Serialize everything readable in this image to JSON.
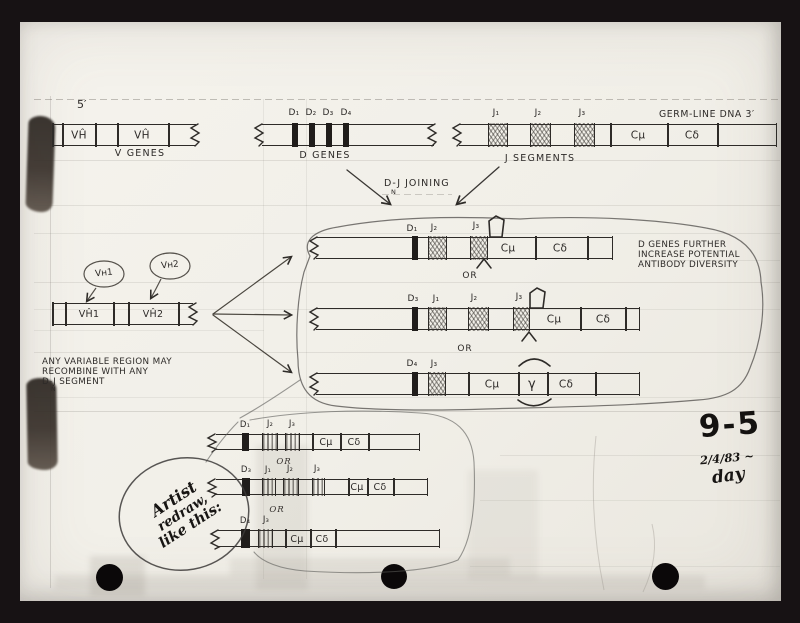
{
  "document": {
    "figure_number": "9-5",
    "date": "2/4/83 ~",
    "signoff": "day"
  },
  "germline_row": {
    "five_prime": "5′",
    "three_prime": "GERM-LINE DNA 3′",
    "v_genes": {
      "caption": "V GENES",
      "segment1": "VĤ",
      "segment2": "VĤ"
    },
    "d_genes": {
      "caption": "D GENES",
      "d1": "D₁",
      "d2": "D₂",
      "d3": "D₃",
      "d4": "D₄"
    },
    "j_segments": {
      "caption": "J SEGMENTS",
      "j1": "J₁",
      "j2": "J₂",
      "j3": "J₃",
      "c_mu": "Cμ",
      "c_delta": "Cδ"
    }
  },
  "joining": {
    "label": "D-J JOINING",
    "n": "N"
  },
  "rearranged": {
    "or": "OR",
    "note": {
      "line1": "D GENES FURTHER",
      "line2": "INCREASE POTENTIAL",
      "line3": "ANTIBODY DIVERSITY"
    },
    "row1": {
      "d": "D₁",
      "j1": "J₂",
      "j2": "J₃",
      "c_mu": "Cμ",
      "c_delta": "Cδ"
    },
    "row2": {
      "d": "D₃",
      "j1": "J₁",
      "j2": "J₂",
      "j3": "J₃",
      "c_mu": "Cμ",
      "c_delta": "Cδ"
    },
    "row3": {
      "d": "D₄",
      "j1": "J₃",
      "c_mu": "Cμ",
      "gamma": "γ",
      "c_delta": "Cδ"
    }
  },
  "variable_region": {
    "bubble1": "Vʜ1",
    "bubble2": "Vʜ2",
    "segment1": "VĤ1",
    "segment2": "VĤ2",
    "note": {
      "line1": "ANY VARIABLE REGION MAY",
      "line2": "RECOMBINE WITH ANY",
      "line3": "D-J SEGMENT",
      "n": "N"
    }
  },
  "redraw": {
    "or": "OR",
    "artist_note": {
      "line1": "Artist",
      "line2": "redraw,",
      "line3": "like this:"
    },
    "row1": {
      "d": "D₁",
      "j1": "J₂",
      "j2": "J₃",
      "c_mu": "Cμ",
      "c_delta": "Cδ"
    },
    "row2": {
      "d": "D₃",
      "j1": "J₁",
      "j2": "J₂",
      "j3": "J₃",
      "c_mu": "Cμ",
      "c_delta": "Cδ"
    },
    "row3": {
      "d": "D₄",
      "j1": "J₃",
      "c_mu": "Cμ",
      "c_delta": "Cδ"
    }
  }
}
